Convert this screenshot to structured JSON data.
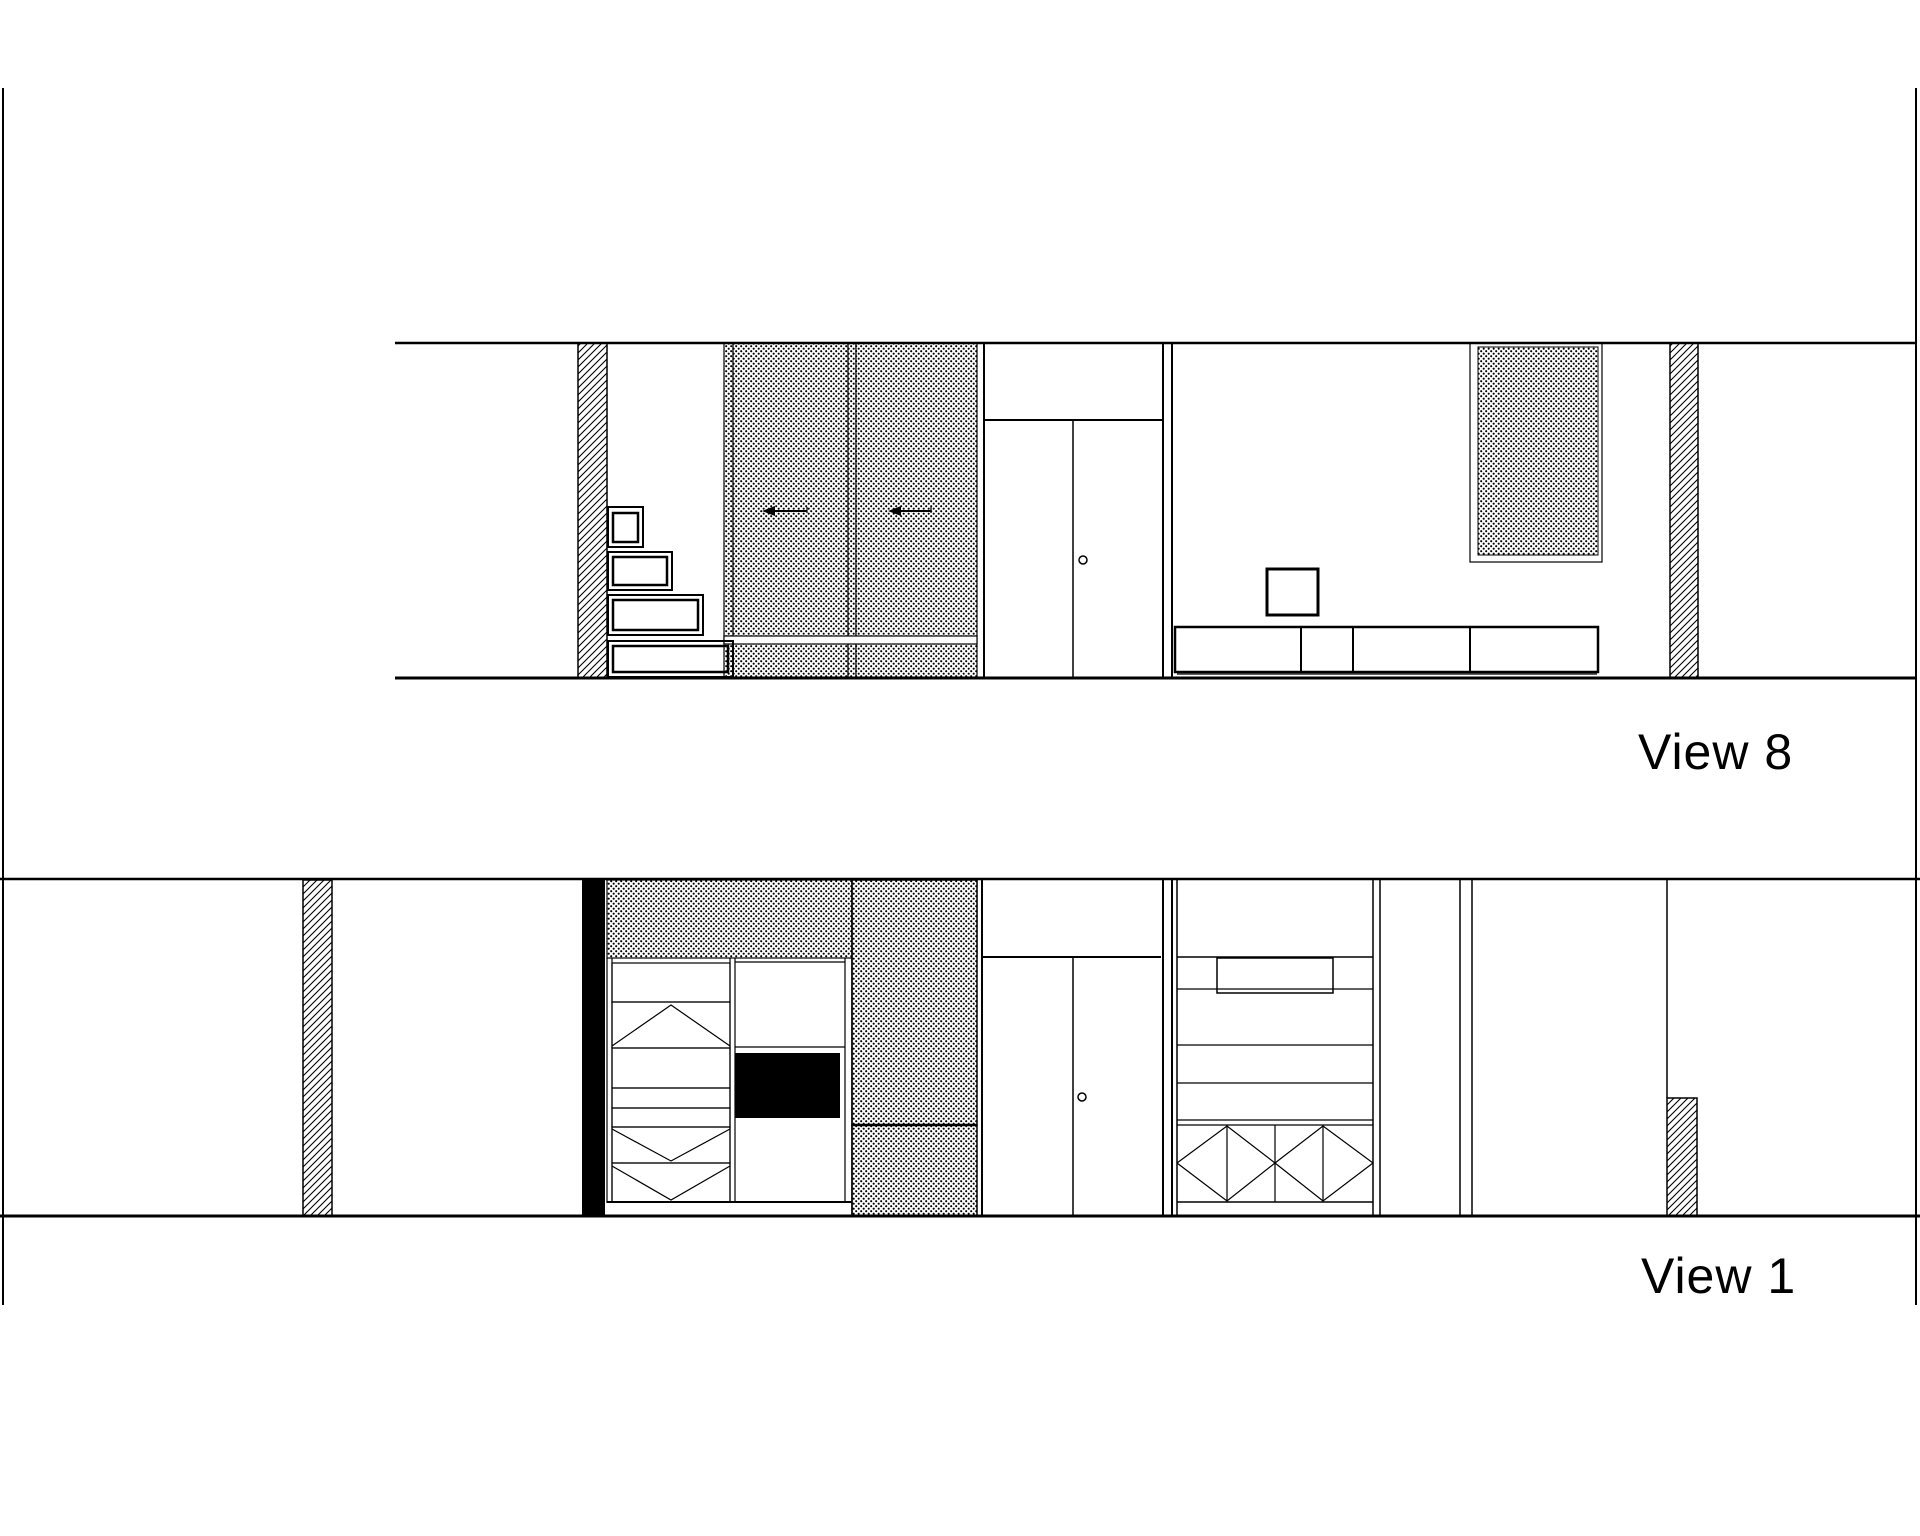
{
  "page": {
    "width": 1920,
    "height": 1536,
    "background": "#ffffff",
    "ink": "#000000"
  },
  "labels": {
    "view8": "View 8",
    "view1": "View 1"
  },
  "drawing": {
    "patterns": {
      "dots_cell": 5,
      "dots_radius": 1.05,
      "hatch_cell": 7,
      "hatch_stroke": 1.1
    },
    "shapes": [
      {
        "name": "page-border-left",
        "type": "vline",
        "x": 3,
        "y1": 88,
        "y2": 1305,
        "w": 2
      },
      {
        "name": "page-border-right",
        "type": "vline",
        "x": 1916,
        "y1": 88,
        "y2": 1305,
        "w": 2
      },
      {
        "name": "v8-cut-wall-hatch-left",
        "type": "rect",
        "x": 578,
        "y": 343,
        "w": 29,
        "h": 335,
        "sw": 1.5,
        "fill": "hatch"
      },
      {
        "name": "v8-slider-edge-strip",
        "type": "rect",
        "x": 724,
        "y": 343,
        "w": 9,
        "h": 335,
        "sw": 1.2,
        "fill": "dots"
      },
      {
        "name": "v8-slider-door-a",
        "type": "rect",
        "x": 733,
        "y": 343,
        "w": 115,
        "h": 335,
        "sw": 1.2,
        "fill": "dots"
      },
      {
        "name": "v8-slider-divider",
        "type": "rect",
        "x": 848,
        "y": 343,
        "w": 8,
        "h": 335,
        "sw": 1.2,
        "fill": "dots"
      },
      {
        "name": "v8-slider-door-b",
        "type": "rect",
        "x": 856,
        "y": 343,
        "w": 121,
        "h": 335,
        "sw": 1.2,
        "fill": "dots"
      },
      {
        "name": "v8-slider-rail-band",
        "type": "rect",
        "x": 724,
        "y": 636,
        "w": 253,
        "h": 8,
        "sw": 1.2,
        "fill": "white"
      },
      {
        "name": "v8-wall-panel-frame",
        "type": "rect",
        "x": 1470,
        "y": 343,
        "w": 132,
        "h": 219,
        "sw": 1.2,
        "fill": "none"
      },
      {
        "name": "v8-wall-panel-dots",
        "type": "rect",
        "x": 1478,
        "y": 347,
        "w": 120,
        "h": 208,
        "sw": 1,
        "fill": "dots"
      },
      {
        "name": "v8-cut-wall-hatch-right",
        "type": "rect",
        "x": 1670,
        "y": 343,
        "w": 28,
        "h": 335,
        "sw": 1.5,
        "fill": "hatch"
      },
      {
        "name": "v8-ceiling-line",
        "type": "hline",
        "y": 343,
        "x1": 395,
        "x2": 1917,
        "w": 2.5
      },
      {
        "name": "v8-floor-line",
        "type": "hline",
        "y": 678,
        "x1": 395,
        "x2": 1916,
        "w": 3
      },
      {
        "name": "v8-stair-step1-outer",
        "type": "rect",
        "x": 608,
        "y": 507,
        "w": 35,
        "h": 40,
        "sw": 2,
        "fill": "none"
      },
      {
        "name": "v8-stair-step1-inner",
        "type": "rect",
        "x": 613,
        "y": 513,
        "w": 25,
        "h": 29,
        "sw": 2.5,
        "fill": "none"
      },
      {
        "name": "v8-stair-step2-outer",
        "type": "rect",
        "x": 608,
        "y": 552,
        "w": 64,
        "h": 38,
        "sw": 2,
        "fill": "none"
      },
      {
        "name": "v8-stair-step2-inner",
        "type": "rect",
        "x": 613,
        "y": 557,
        "w": 54,
        "h": 28,
        "sw": 2.5,
        "fill": "none"
      },
      {
        "name": "v8-stair-step3-outer",
        "type": "rect",
        "x": 608,
        "y": 595,
        "w": 95,
        "h": 40,
        "sw": 2,
        "fill": "none"
      },
      {
        "name": "v8-stair-step3-inner",
        "type": "rect",
        "x": 613,
        "y": 600,
        "w": 85,
        "h": 30,
        "sw": 2.5,
        "fill": "none"
      },
      {
        "name": "v8-stair-step4-outer",
        "type": "rect",
        "x": 608,
        "y": 641,
        "w": 125,
        "h": 36,
        "sw": 2,
        "fill": "none"
      },
      {
        "name": "v8-stair-step4-inner",
        "type": "rect",
        "x": 613,
        "y": 646,
        "w": 115,
        "h": 26,
        "sw": 2.5,
        "fill": "none"
      },
      {
        "name": "v8-door-bay-left-line",
        "type": "vline",
        "x": 984,
        "y1": 343,
        "y2": 678,
        "w": 2
      },
      {
        "name": "v8-door-lintel-line",
        "type": "hline",
        "y": 420,
        "x1": 984,
        "x2": 1163,
        "w": 2
      },
      {
        "name": "v8-door-leaf-split-line",
        "type": "vline",
        "x": 1073,
        "y1": 420,
        "y2": 678,
        "w": 1.5
      },
      {
        "name": "v8-door-knob",
        "type": "circle",
        "cx": 1083,
        "cy": 560,
        "r": 4,
        "sw": 1.5
      },
      {
        "name": "v8-partition-line-a",
        "type": "vline",
        "x": 1163,
        "y1": 343,
        "y2": 678,
        "w": 2
      },
      {
        "name": "v8-partition-line-b",
        "type": "vline",
        "x": 1172,
        "y1": 343,
        "y2": 678,
        "w": 2
      },
      {
        "name": "v8-wall-art-box",
        "type": "rect",
        "x": 1267,
        "y": 569,
        "w": 51,
        "h": 46,
        "sw": 3,
        "fill": "none"
      },
      {
        "name": "v8-lowboard-outline",
        "type": "rect",
        "x": 1175,
        "y": 627,
        "w": 423,
        "h": 45,
        "sw": 2.5,
        "fill": "none"
      },
      {
        "name": "v8-lowboard-divider-1",
        "type": "vline",
        "x": 1301,
        "y1": 627,
        "y2": 672,
        "w": 2
      },
      {
        "name": "v8-lowboard-divider-2",
        "type": "vline",
        "x": 1353,
        "y1": 627,
        "y2": 672,
        "w": 2
      },
      {
        "name": "v8-lowboard-divider-3",
        "type": "vline",
        "x": 1470,
        "y1": 627,
        "y2": 672,
        "w": 2
      },
      {
        "name": "v8-lowboard-plinth-line",
        "type": "hline",
        "y": 674,
        "x1": 1177,
        "x2": 1597,
        "w": 1.2
      },
      {
        "name": "v8-slider-arrow-a",
        "type": "arrow",
        "hx": 762,
        "hy": 511,
        "tx": 807,
        "ty": 511
      },
      {
        "name": "v8-slider-arrow-b",
        "type": "arrow",
        "hx": 888,
        "hy": 511,
        "tx": 931,
        "ty": 511
      },
      {
        "name": "v1-cut-wall-hatch",
        "type": "rect",
        "x": 303,
        "y": 880,
        "w": 29,
        "h": 336,
        "sw": 1.5,
        "fill": "hatch"
      },
      {
        "name": "v1-cut-wall-solid",
        "type": "rect",
        "x": 582,
        "y": 880,
        "w": 23,
        "h": 336,
        "sw": 0,
        "fill": "black"
      },
      {
        "name": "v1-soffit-dots",
        "type": "rect",
        "x": 607,
        "y": 880,
        "w": 370,
        "h": 78,
        "sw": 1.2,
        "fill": "dots"
      },
      {
        "name": "v1-slider-upper-dots",
        "type": "rect",
        "x": 852,
        "y": 880,
        "w": 125,
        "h": 245,
        "sw": 1.5,
        "fill": "dots"
      },
      {
        "name": "v1-slider-lower-dots",
        "type": "rect",
        "x": 852,
        "y": 1125,
        "w": 125,
        "h": 91,
        "sw": 1.5,
        "fill": "dots"
      },
      {
        "name": "v1-half-wall-hatch",
        "type": "rect",
        "x": 1667,
        "y": 1098,
        "w": 30,
        "h": 118,
        "sw": 1.5,
        "fill": "hatch"
      },
      {
        "name": "v1-ceiling-line",
        "type": "hline",
        "y": 879,
        "x1": 0,
        "x2": 1920,
        "w": 2.5
      },
      {
        "name": "v1-wardrobe-left-line-a",
        "type": "vline",
        "x": 607,
        "y1": 958,
        "y2": 1203,
        "w": 1.2
      },
      {
        "name": "v1-wardrobe-left-line-b",
        "type": "vline",
        "x": 612,
        "y1": 958,
        "y2": 1203,
        "w": 1.2
      },
      {
        "name": "v1-shelf-row-1",
        "type": "rect",
        "x": 612,
        "y": 963,
        "w": 118,
        "h": 39,
        "sw": 1.2,
        "fill": "none"
      },
      {
        "name": "v1-shelf-row-2",
        "type": "rect",
        "x": 612,
        "y": 1002,
        "w": 118,
        "h": 46,
        "sw": 1.2,
        "fill": "none"
      },
      {
        "name": "v1-chevron-up",
        "type": "poly",
        "pts": [
          [
            612,
            1046
          ],
          [
            671,
            1005
          ],
          [
            730,
            1046
          ]
        ],
        "sw": 1.2
      },
      {
        "name": "v1-shelf-row-3",
        "type": "rect",
        "x": 612,
        "y": 1048,
        "w": 118,
        "h": 40,
        "sw": 1.2,
        "fill": "none"
      },
      {
        "name": "v1-drawer-row-1",
        "type": "rect",
        "x": 612,
        "y": 1088,
        "w": 118,
        "h": 20,
        "sw": 1.2,
        "fill": "none"
      },
      {
        "name": "v1-drawer-row-2",
        "type": "rect",
        "x": 612,
        "y": 1108,
        "w": 118,
        "h": 19,
        "sw": 1.2,
        "fill": "none"
      },
      {
        "name": "v1-shelf-row-4",
        "type": "rect",
        "x": 612,
        "y": 1127,
        "w": 118,
        "h": 36,
        "sw": 1.2,
        "fill": "none"
      },
      {
        "name": "v1-chevron-down-1",
        "type": "poly",
        "pts": [
          [
            612,
            1129
          ],
          [
            671,
            1161
          ],
          [
            730,
            1129
          ]
        ],
        "sw": 1.2
      },
      {
        "name": "v1-shelf-row-5",
        "type": "rect",
        "x": 612,
        "y": 1163,
        "w": 118,
        "h": 39,
        "sw": 1.2,
        "fill": "none"
      },
      {
        "name": "v1-chevron-down-2",
        "type": "poly",
        "pts": [
          [
            612,
            1166
          ],
          [
            671,
            1200
          ],
          [
            730,
            1166
          ]
        ],
        "sw": 1.2
      },
      {
        "name": "v1-wardrobe-mid-line-a",
        "type": "vline",
        "x": 730,
        "y1": 958,
        "y2": 1203,
        "w": 1.2
      },
      {
        "name": "v1-wardrobe-mid-line-b",
        "type": "vline",
        "x": 735,
        "y1": 958,
        "y2": 1203,
        "w": 1.2
      },
      {
        "name": "v1-mid-top-line",
        "type": "hline",
        "y": 962,
        "x1": 735,
        "x2": 845,
        "w": 1.2
      },
      {
        "name": "v1-mid-shelf-line",
        "type": "hline",
        "y": 1047,
        "x1": 735,
        "x2": 845,
        "w": 1.2
      },
      {
        "name": "v1-tv-panel",
        "type": "rect",
        "x": 735,
        "y": 1053,
        "w": 105,
        "h": 65,
        "sw": 0,
        "fill": "black"
      },
      {
        "name": "v1-wardrobe-right-line",
        "type": "vline",
        "x": 845,
        "y1": 958,
        "y2": 1203,
        "w": 1.2
      },
      {
        "name": "v1-slider-left-line",
        "type": "vline",
        "x": 852,
        "y1": 880,
        "y2": 1216,
        "w": 1.5
      },
      {
        "name": "v1-wardrobe-base-line",
        "type": "hline",
        "y": 1202,
        "x1": 607,
        "x2": 852,
        "w": 2
      },
      {
        "name": "v1-slider-split-line",
        "type": "hline",
        "y": 1125,
        "x1": 852,
        "x2": 977,
        "w": 2.5
      },
      {
        "name": "v1-door-bay-left-line",
        "type": "vline",
        "x": 982,
        "y1": 879,
        "y2": 1216,
        "w": 2
      },
      {
        "name": "v1-door-lintel-line",
        "type": "hline",
        "y": 957,
        "x1": 982,
        "x2": 1161,
        "w": 2
      },
      {
        "name": "v1-door-leaf-split-line",
        "type": "vline",
        "x": 1073,
        "y1": 957,
        "y2": 1216,
        "w": 1.5
      },
      {
        "name": "v1-door-knob",
        "type": "circle",
        "cx": 1082,
        "cy": 1097,
        "r": 4,
        "sw": 1.5
      },
      {
        "name": "v1-partition-line-a",
        "type": "vline",
        "x": 1163,
        "y1": 879,
        "y2": 1216,
        "w": 2
      },
      {
        "name": "v1-partition-line-b",
        "type": "vline",
        "x": 1172,
        "y1": 879,
        "y2": 1216,
        "w": 2
      },
      {
        "name": "v1-cabinet-left-line",
        "type": "vline",
        "x": 1177,
        "y1": 879,
        "y2": 1216,
        "w": 1.5
      },
      {
        "name": "v1-cabinet-top-line",
        "type": "hline",
        "y": 957,
        "x1": 1177,
        "x2": 1373,
        "w": 1.5
      },
      {
        "name": "v1-open-niche",
        "type": "rect",
        "x": 1217,
        "y": 958,
        "w": 116,
        "h": 35,
        "sw": 1.5,
        "fill": "none"
      },
      {
        "name": "v1-cabinet-shelf-line-1",
        "type": "hline",
        "y": 989,
        "x1": 1177,
        "x2": 1373,
        "w": 1.2
      },
      {
        "name": "v1-cabinet-shelf-line-2",
        "type": "hline",
        "y": 1045,
        "x1": 1177,
        "x2": 1373,
        "w": 1.2
      },
      {
        "name": "v1-cabinet-shelf-line-3",
        "type": "hline",
        "y": 1083,
        "x1": 1177,
        "x2": 1373,
        "w": 1.2
      },
      {
        "name": "v1-cabinet-shelf-line-4",
        "type": "hline",
        "y": 1120,
        "x1": 1177,
        "x2": 1373,
        "w": 1.2
      },
      {
        "name": "v1-cabinet-shelf-line-5",
        "type": "hline",
        "y": 1125,
        "x1": 1177,
        "x2": 1373,
        "w": 1.2
      },
      {
        "name": "v1-xrow-divider-1",
        "type": "vline",
        "x": 1227,
        "y1": 1125,
        "y2": 1202,
        "w": 1.2
      },
      {
        "name": "v1-xrow-divider-2",
        "type": "vline",
        "x": 1275,
        "y1": 1125,
        "y2": 1202,
        "w": 1.2
      },
      {
        "name": "v1-xrow-divider-3",
        "type": "vline",
        "x": 1323,
        "y1": 1125,
        "y2": 1202,
        "w": 1.2
      },
      {
        "name": "v1-diamond-door-1",
        "type": "poly",
        "pts": [
          [
            1177,
            1163
          ],
          [
            1227,
            1126
          ],
          [
            1275,
            1163
          ],
          [
            1227,
            1201
          ],
          [
            1177,
            1163
          ]
        ],
        "sw": 1.2
      },
      {
        "name": "v1-diamond-door-2",
        "type": "poly",
        "pts": [
          [
            1275,
            1163
          ],
          [
            1323,
            1126
          ],
          [
            1373,
            1163
          ],
          [
            1323,
            1201
          ],
          [
            1275,
            1163
          ]
        ],
        "sw": 1.2
      },
      {
        "name": "v1-cabinet-base-line",
        "type": "hline",
        "y": 1202,
        "x1": 1177,
        "x2": 1373,
        "w": 1.5
      },
      {
        "name": "v1-cabinet-right-line-a",
        "type": "vline",
        "x": 1373,
        "y1": 879,
        "y2": 1216,
        "w": 1.5
      },
      {
        "name": "v1-cabinet-right-line-b",
        "type": "vline",
        "x": 1380,
        "y1": 879,
        "y2": 1216,
        "w": 1.5
      },
      {
        "name": "v1-post-line-a",
        "type": "vline",
        "x": 1460,
        "y1": 879,
        "y2": 1216,
        "w": 1.5
      },
      {
        "name": "v1-post-line-b",
        "type": "vline",
        "x": 1472,
        "y1": 879,
        "y2": 1216,
        "w": 1.5
      },
      {
        "name": "v1-wall-corner-line",
        "type": "vline",
        "x": 1667,
        "y1": 879,
        "y2": 1098,
        "w": 1.5
      },
      {
        "name": "v1-floor-line",
        "type": "hline",
        "y": 1216,
        "x1": 0,
        "x2": 1920,
        "w": 3
      }
    ]
  }
}
